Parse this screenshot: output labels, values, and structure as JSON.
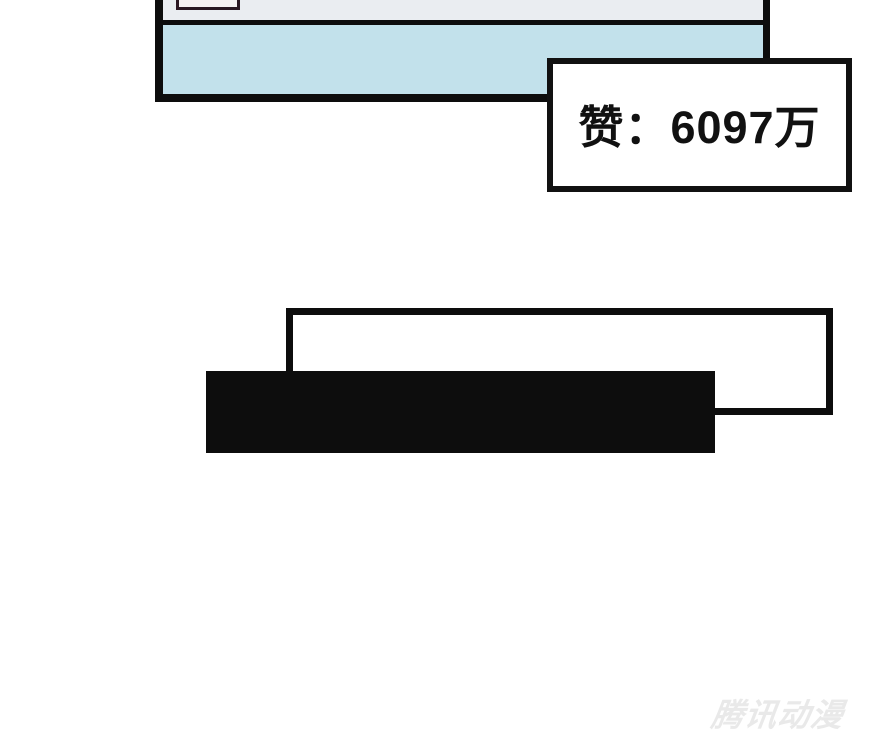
{
  "page": {
    "background": "#ffffff"
  },
  "comic_panel": {
    "header_fill": "#eaedf1",
    "body_fill": "#c2e1eb",
    "border_color": "#0d0d0d",
    "inset_box": {
      "border_color": "#2b1722",
      "fill": "#f6f1f3"
    }
  },
  "like_counter": {
    "text": "赞：6097万",
    "text_color": "#111111",
    "fill": "#ffffff",
    "border_color": "#111111"
  },
  "caption_shapes": {
    "outlined_box_border": "#0d0d0d",
    "outlined_box_fill": "#ffffff",
    "solid_bar_fill": "#0d0d0d"
  },
  "watermark": {
    "text": "腾讯动漫",
    "color": "#e9e9e9"
  }
}
